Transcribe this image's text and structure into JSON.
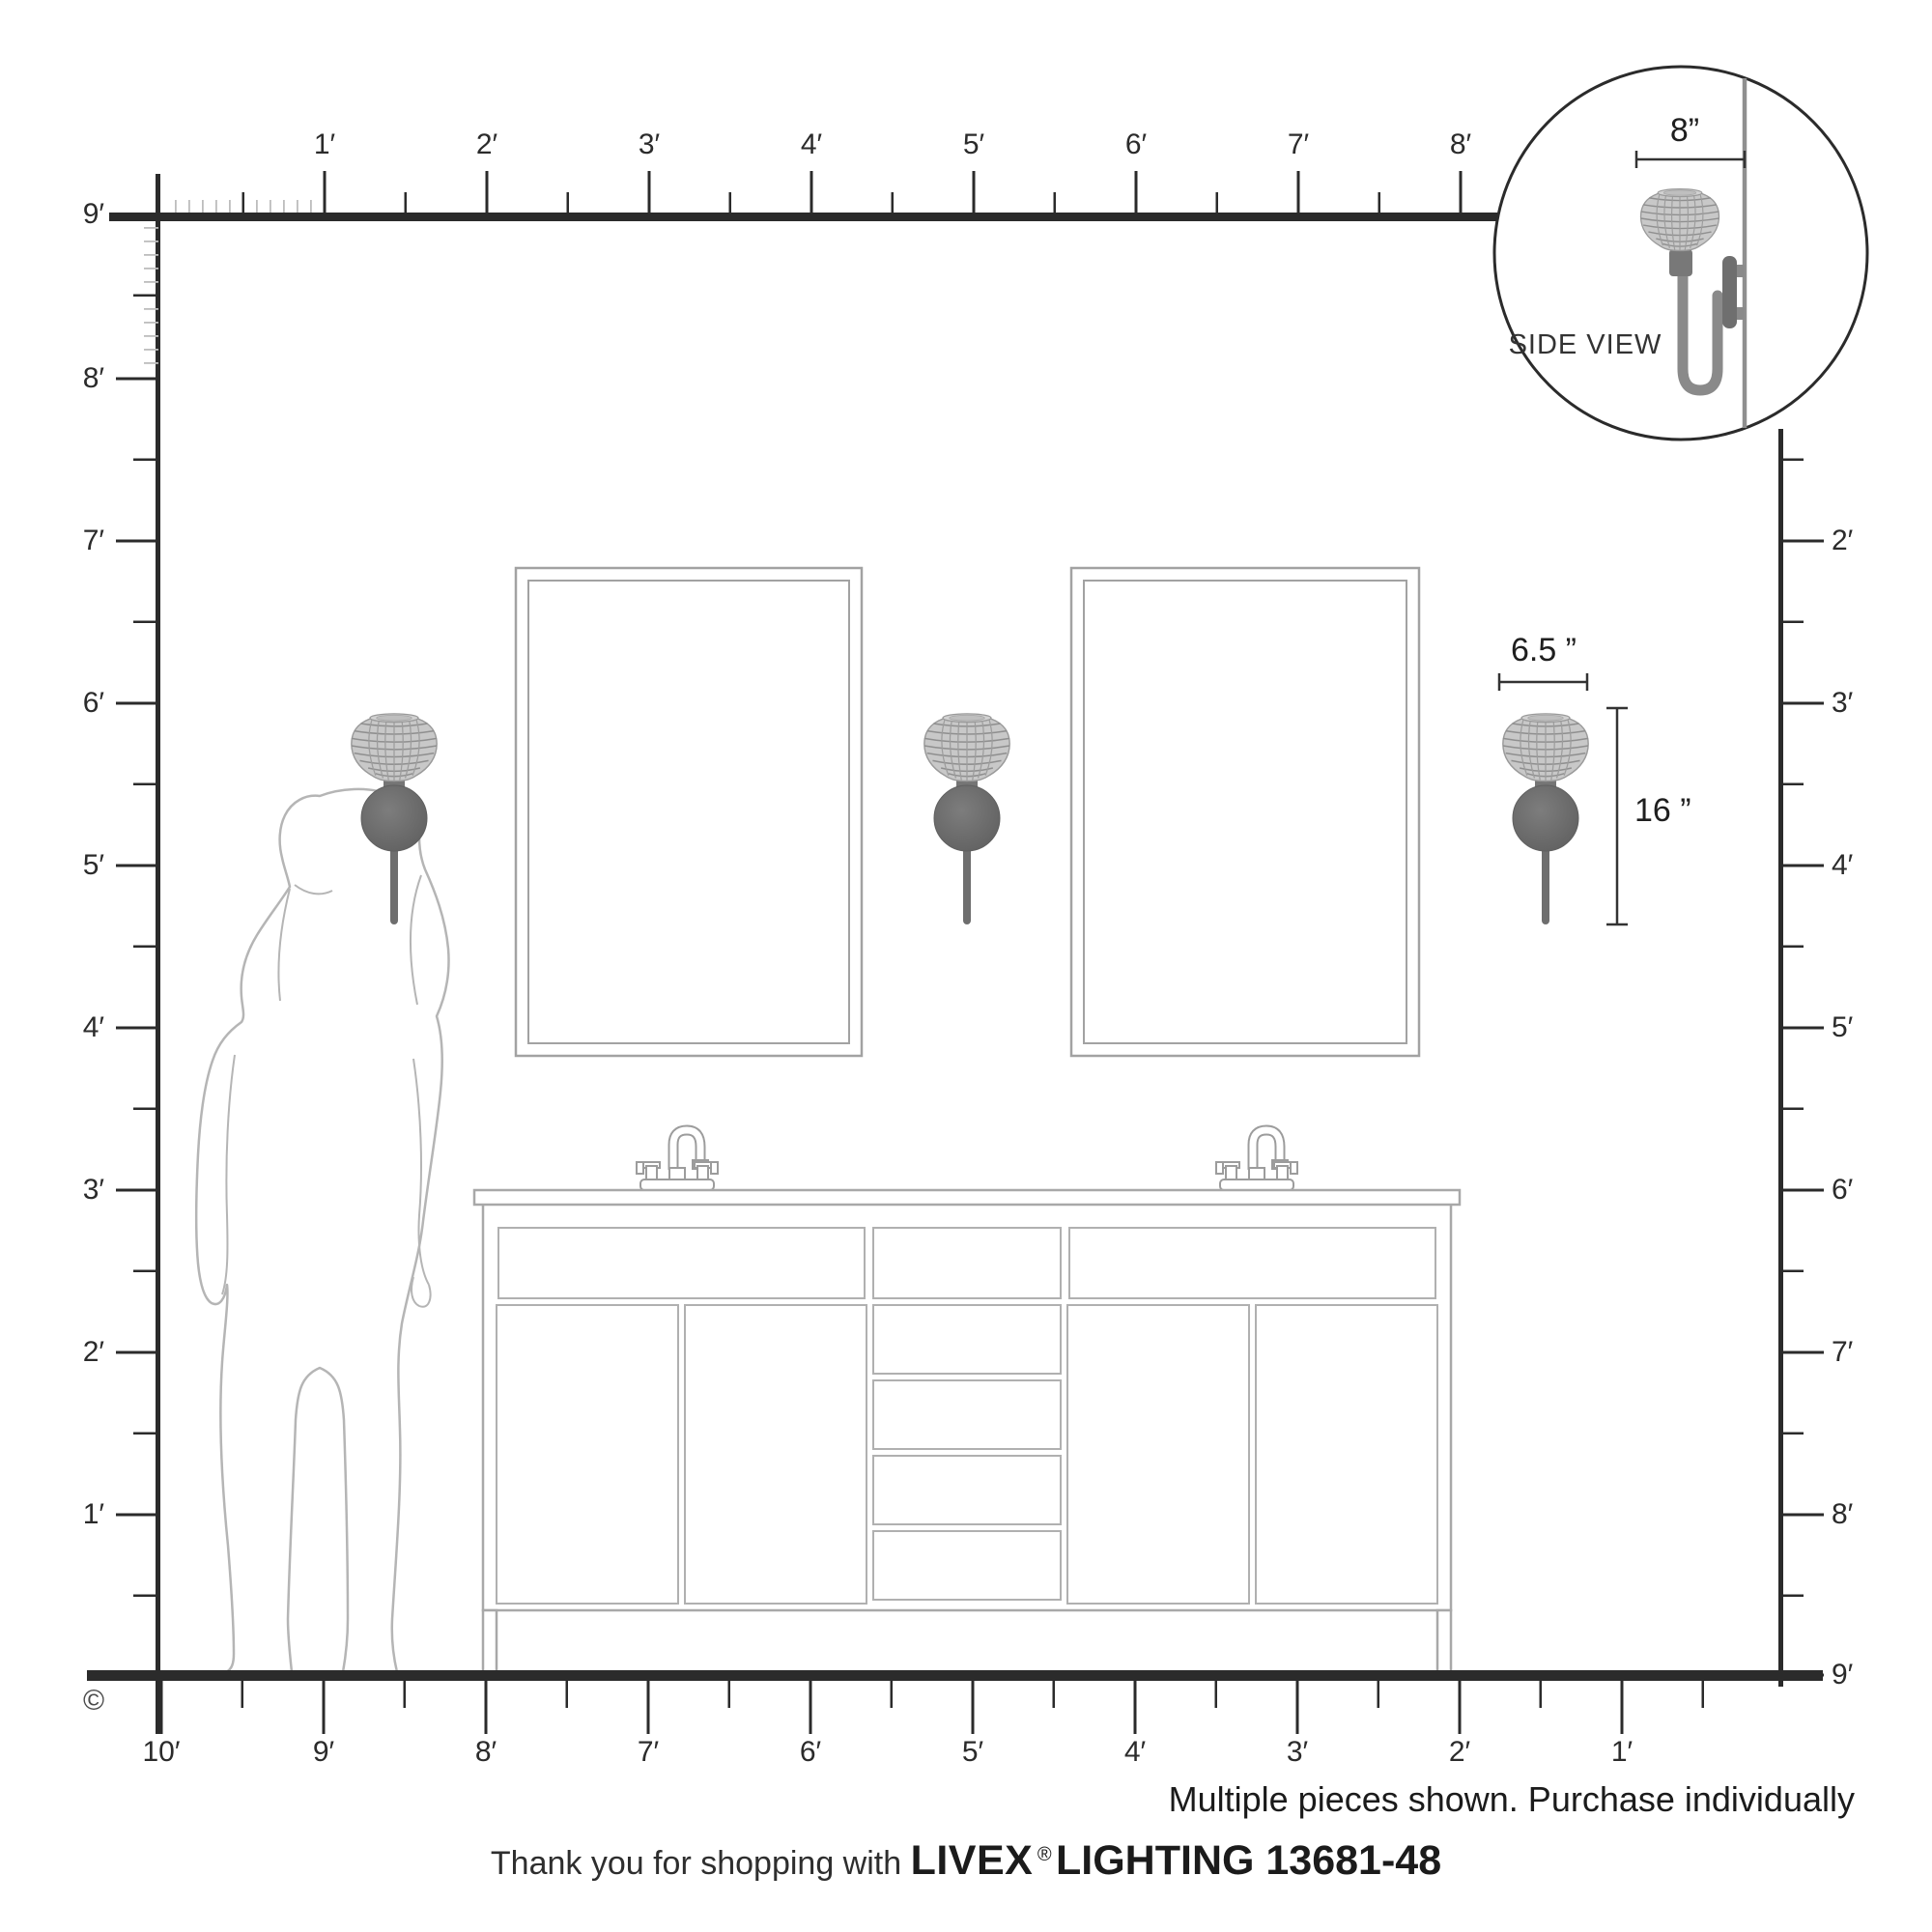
{
  "title": "Livex Lighting 13681-48 wall sconce scale diagram",
  "rulers": {
    "top": [
      "1′",
      "2′",
      "3′",
      "4′",
      "5′",
      "6′",
      "7′",
      "8′"
    ],
    "left": [
      "9′",
      "8′",
      "7′",
      "6′",
      "5′",
      "4′",
      "3′",
      "2′",
      "1′"
    ],
    "right": [
      "2′",
      "3′",
      "4′",
      "5′",
      "6′",
      "7′",
      "8′",
      "9′"
    ],
    "bottom": [
      "10′",
      "9′",
      "8′",
      "7′",
      "6′",
      "5′",
      "4′",
      "3′",
      "2′",
      "1′"
    ]
  },
  "inset": {
    "label": "SIDE VIEW",
    "depth_dim": "8”"
  },
  "dims": {
    "shade_width": "6.5 ”",
    "fixture_height": "16 ”"
  },
  "notice": "Multiple pieces shown. Purchase individually",
  "footer": {
    "prefix": "Thank you for shopping with ",
    "brand": "LIVEX",
    "reg": "®",
    "suffix": " LIGHTING 13681-48"
  },
  "copyright": "©",
  "colors": {
    "ink": "#2b2b2b",
    "furniture_line": "#a5a5a5",
    "fine_tick": "#bdbdbd",
    "metal": "#6e6e6e",
    "shade_fill": "#c8c8c8"
  }
}
